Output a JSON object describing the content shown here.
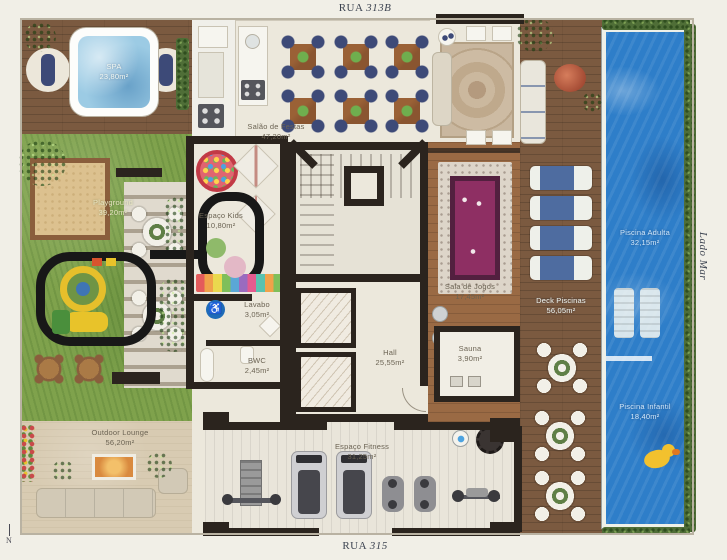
{
  "streets": {
    "top_name": "RUA",
    "top_num": "313B",
    "bottom_name": "RUA",
    "bottom_num": "315",
    "side": "Lado Mar",
    "north": "N"
  },
  "icons": {
    "accessible_icon": "♿"
  },
  "rooms": {
    "spa": {
      "name": "SPA",
      "area": "23,80m²"
    },
    "playground": {
      "name": "Playground",
      "area": "39,20m²"
    },
    "espaco_kids": {
      "name": "Espaço Kids",
      "area": "10,80m²"
    },
    "salao_festas": {
      "name": "Salão de Festas",
      "area": "47,20m²"
    },
    "lavabo": {
      "name": "Lavabo",
      "area": "3,05m²"
    },
    "bwc": {
      "name": "BWC",
      "area": "2,45m²"
    },
    "hall": {
      "name": "Hall",
      "area": "25,55m²"
    },
    "sala_jogos": {
      "name": "Sala de Jogos",
      "area": "17,45m²"
    },
    "sauna": {
      "name": "Sauna",
      "area": "3,90m²"
    },
    "deck_piscinas": {
      "name": "Deck Piscinas",
      "area": "56,05m²"
    },
    "piscina_adulta": {
      "name": "Piscina Adulta",
      "area": "32,15m²"
    },
    "piscina_infantil": {
      "name": "Piscina Infantil",
      "area": "18,40m²"
    },
    "outdoor_lounge": {
      "name": "Outdoor Lounge",
      "area": "56,20m²"
    },
    "espaco_fitness": {
      "name": "Espaço Fitness",
      "area": "31,25m²"
    }
  },
  "colors": {
    "page_bg": "#f1efe7",
    "wall": "#2b241e",
    "wood_deck": "#7b5a40",
    "wood_floor": "#9a6a44",
    "grass": "#7fa24c",
    "sand": "#dcc18f",
    "pool": "#2e7ec9",
    "cream": "#ece8dc",
    "paving": "#d8cbb2",
    "pergola": "#d5cdbd",
    "chair_navy": "#3d4a78",
    "table_wood": "#8a5530",
    "pool_table": "#8e2f63",
    "fitness_floor": "#e9e5da",
    "label": "#6b6353",
    "hedge": "#4f6e37"
  }
}
